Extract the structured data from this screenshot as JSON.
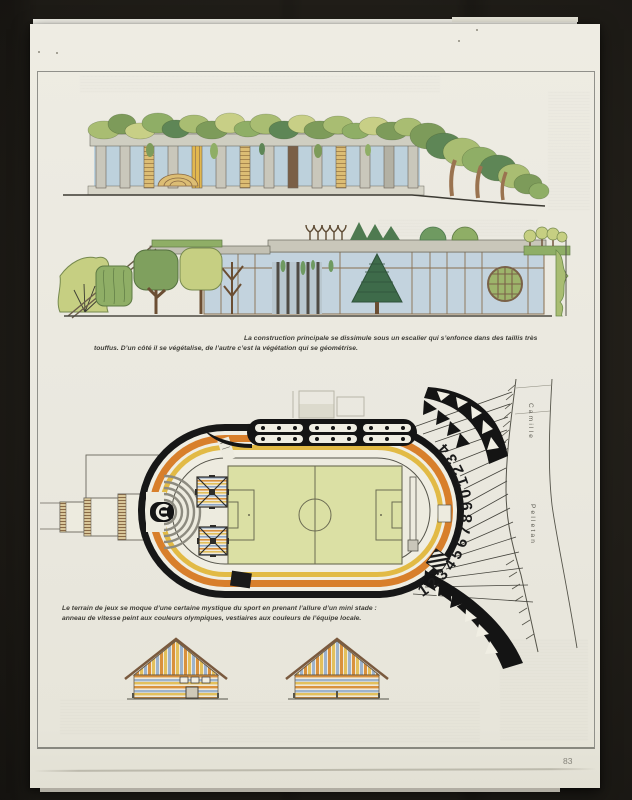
{
  "document": {
    "page_number": "83",
    "captions": {
      "upper": {
        "line1": "La construction principale se dissimule sous un escalier qui s’enfonce dans des taillis très",
        "line2": "touffus. D’un côté il se végétalise, de l’autre c’est la végétation qui se géométrise."
      },
      "lower": {
        "line1": "Le terrain de jeux se moque d’une certaine mystique du sport en prenant l’allure d’un mini stade :",
        "line2": "anneau de vitesse peint aux couleurs olympiques, vestiaires aux couleurs de l’équipe locale."
      }
    },
    "plan_labels": {
      "street_word_1": "Camille",
      "street_word_2": "Pelletan",
      "track_numbers": "12345678901234"
    },
    "colors": {
      "paper": "#eae8df",
      "backdrop": "#25221c",
      "ink_black": "#171717",
      "track_orange": "#d87f2b",
      "track_yellow": "#e2ba45",
      "field_green": "#dbe0a4",
      "glass_blue": "#bdd1dc",
      "foliage_green": "#8fae66",
      "stripe_blue": "#9db3cc"
    }
  }
}
